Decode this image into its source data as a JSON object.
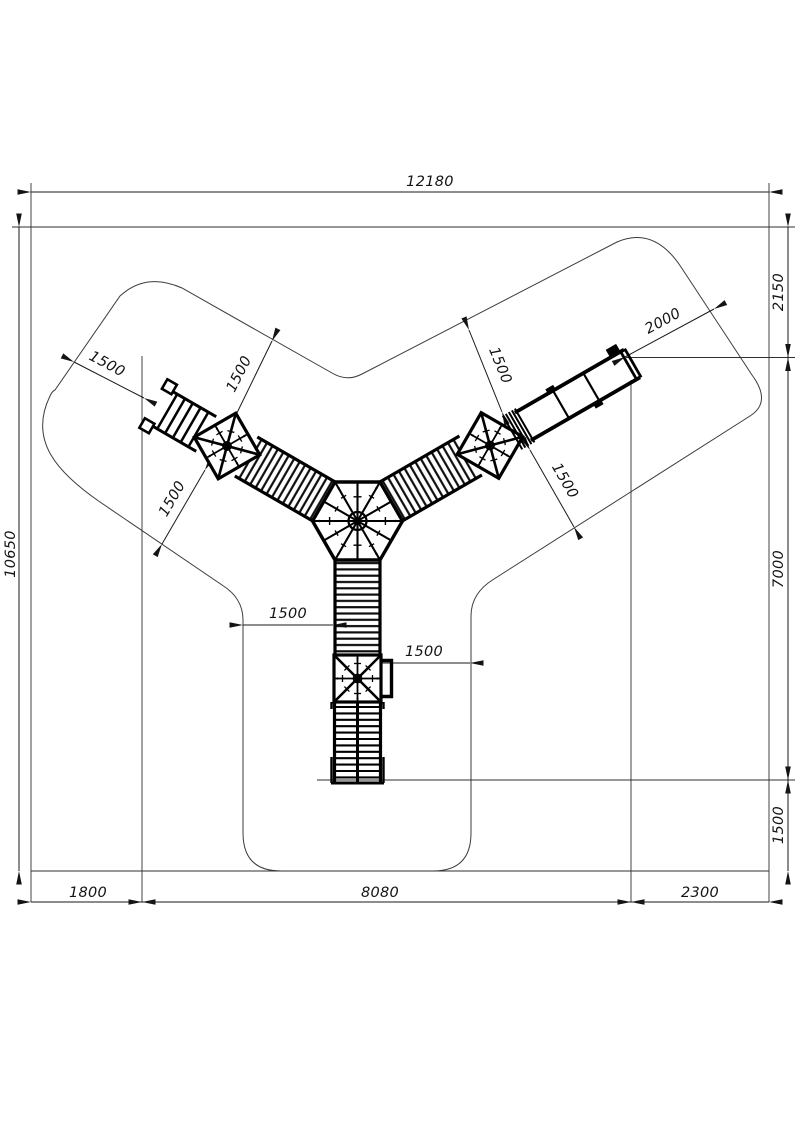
{
  "drawing": {
    "title": "playground-structure-plan-view",
    "units": "mm",
    "dimensions": {
      "total_width": "12180",
      "total_height": "10650",
      "right_top": "2150",
      "right_middle": "7000",
      "right_bottom": "1500",
      "bottom_left": "1800",
      "bottom_middle": "8080",
      "bottom_right": "2300",
      "slide_clearance": "2000",
      "ladder_clearance": "1500",
      "left_arm_upper_clearance": "1500",
      "left_arm_lower_clearance": "1500",
      "right_arm_upper_clearance": "1500",
      "right_arm_lower_clearance": "1500",
      "bottom_arm_left_clearance": "1500",
      "bottom_arm_right_clearance": "1500"
    }
  }
}
